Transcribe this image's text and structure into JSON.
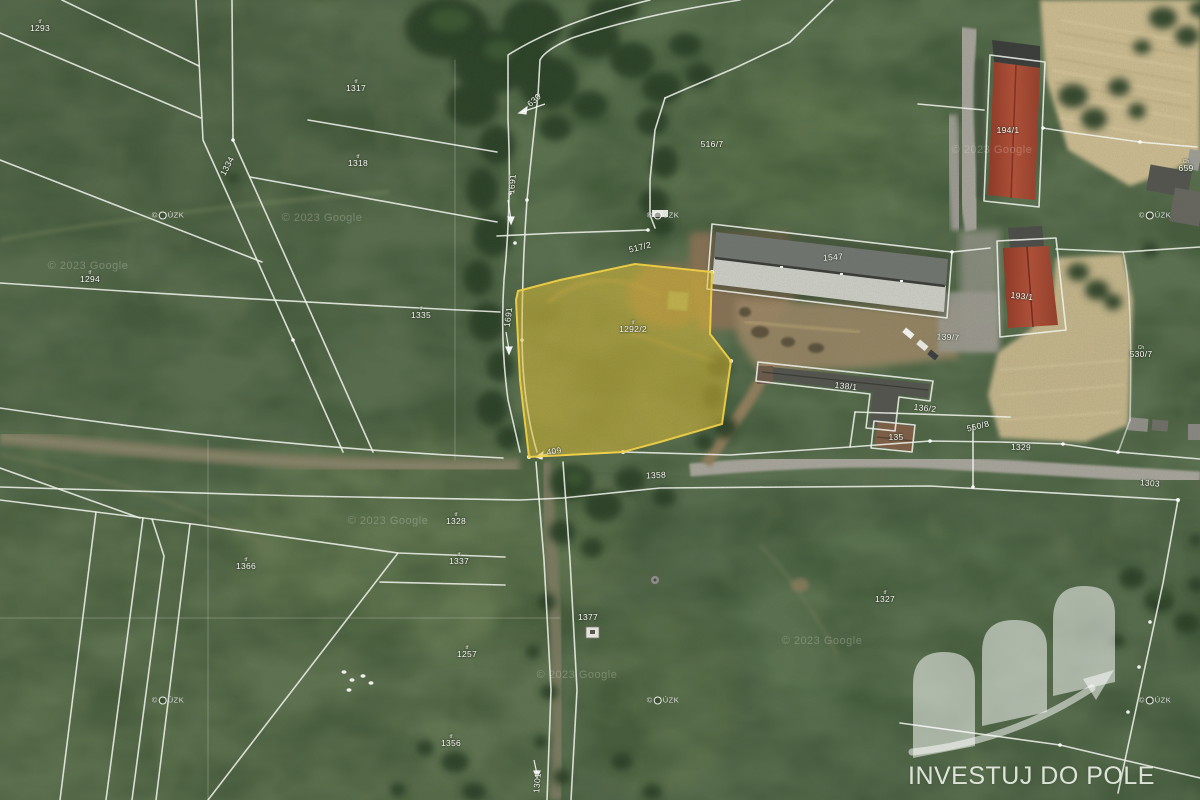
{
  "map": {
    "kind": "satellite-cadastral",
    "colors": {
      "field_green": "#5b7050",
      "boundary_line": "#f6f8f2",
      "highlight_fill": "#e3bf35",
      "highlight_stroke": "#f2d244",
      "roof_red": "#a64734",
      "roof_gray": "#c9cac2",
      "dry_field_tan": "#c8b88e"
    },
    "highlighted_parcel": {
      "prefix": "tř",
      "number": "1292/2"
    },
    "labels": [
      {
        "t": "1293",
        "x": 40,
        "y": 26,
        "p": "tř"
      },
      {
        "t": "1317",
        "x": 356,
        "y": 86,
        "p": "tř"
      },
      {
        "t": "1318",
        "x": 358,
        "y": 161,
        "p": "tř"
      },
      {
        "t": "1294",
        "x": 90,
        "y": 277,
        "p": "tř"
      },
      {
        "t": "1335",
        "x": 421,
        "y": 313,
        "p": "tř"
      },
      {
        "t": "1334",
        "x": 227,
        "y": 166,
        "r": -62
      },
      {
        "t": "516/7",
        "x": 712,
        "y": 144
      },
      {
        "t": "517/2",
        "x": 640,
        "y": 247,
        "r": -14
      },
      {
        "t": "1547",
        "x": 833,
        "y": 257,
        "r": -4
      },
      {
        "t": "194/1",
        "x": 1008,
        "y": 130
      },
      {
        "t": "193/1",
        "x": 1022,
        "y": 296,
        "r": 6
      },
      {
        "t": "139/7",
        "x": 948,
        "y": 337,
        "r": 4
      },
      {
        "t": "138/1",
        "x": 846,
        "y": 386,
        "r": 6
      },
      {
        "t": "136/2",
        "x": 925,
        "y": 408,
        "r": 6
      },
      {
        "t": "135",
        "x": 896,
        "y": 437
      },
      {
        "t": "550/8",
        "x": 978,
        "y": 426,
        "r": -14
      },
      {
        "t": "530/7",
        "x": 1141,
        "y": 352,
        "p": "Ch"
      },
      {
        "t": "659",
        "x": 1186,
        "y": 166,
        "p": "Ch"
      },
      {
        "t": "1328",
        "x": 456,
        "y": 519,
        "p": "tř"
      },
      {
        "t": "1337",
        "x": 459,
        "y": 559,
        "p": "tř"
      },
      {
        "t": "1366",
        "x": 246,
        "y": 564,
        "p": "tř"
      },
      {
        "t": "1377",
        "x": 588,
        "y": 617
      },
      {
        "t": "1257",
        "x": 467,
        "y": 652,
        "p": "tř"
      },
      {
        "t": "1356",
        "x": 451,
        "y": 741,
        "p": "tř"
      },
      {
        "t": "1327",
        "x": 885,
        "y": 597,
        "p": "tř"
      },
      {
        "t": "1303",
        "x": 1150,
        "y": 483,
        "r": 4
      },
      {
        "t": "1329",
        "x": 1021,
        "y": 447,
        "r": 2
      },
      {
        "t": "1358",
        "x": 656,
        "y": 475,
        "r": -3
      },
      {
        "t": "630",
        "x": 534,
        "y": 100,
        "r": -42
      },
      {
        "t": "1691",
        "x": 512,
        "y": 184,
        "r": -85
      },
      {
        "t": "1691",
        "x": 508,
        "y": 317,
        "r": -82
      },
      {
        "t": "409",
        "x": 554,
        "y": 451,
        "r": -8
      },
      {
        "t": "1301",
        "x": 537,
        "y": 783,
        "r": -85
      },
      {
        "t": "1292/2",
        "x": 633,
        "y": 327,
        "p": "tř",
        "hl": true
      }
    ],
    "watermarks": {
      "cuzk_text": "© ČÚZK",
      "cuzk_positions": [
        [
          168,
          215
        ],
        [
          663,
          215
        ],
        [
          1155,
          215
        ],
        [
          168,
          700
        ],
        [
          663,
          700
        ],
        [
          1155,
          700
        ]
      ],
      "google_text": "© 2023 Google",
      "google_positions": [
        [
          88,
          266
        ],
        [
          322,
          218
        ],
        [
          388,
          521
        ],
        [
          577,
          675
        ],
        [
          822,
          641
        ],
        [
          992,
          150
        ]
      ]
    },
    "logo": {
      "text": "INVESTUJ DO POLE"
    }
  }
}
